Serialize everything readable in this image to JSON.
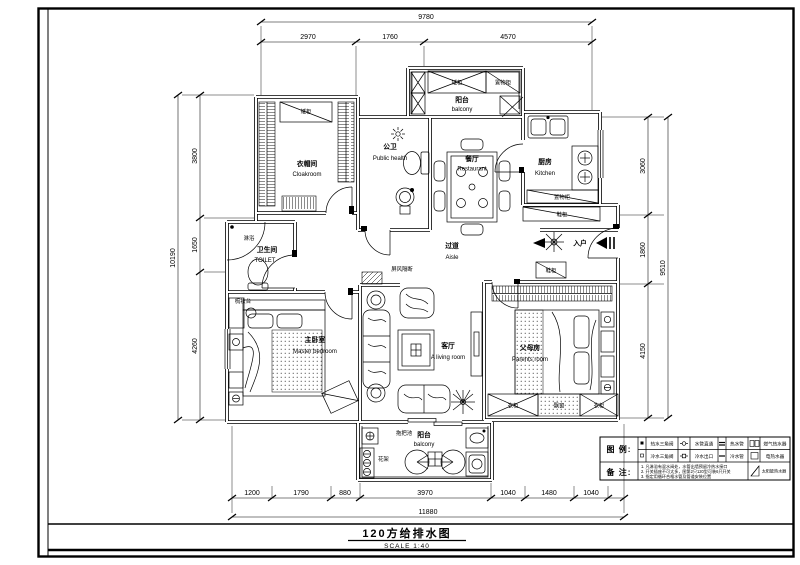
{
  "sheet": {
    "title": "120方给排水图",
    "scale_line": "SCALE    1:40"
  },
  "dims": {
    "top_total": "9780",
    "top": [
      "2970",
      "1760",
      "4570"
    ],
    "left_total": "10190",
    "left": [
      "3800",
      "1650",
      "4260"
    ],
    "right_total": "9510",
    "right": [
      "3060",
      "1860",
      "4150"
    ],
    "bottom_total": "11880",
    "bottom": [
      "1200",
      "1790",
      "880",
      "3970",
      "1040",
      "1480",
      "1040"
    ]
  },
  "rooms": {
    "cloakroom": {
      "zh": "衣帽间",
      "en": "Cloakroom"
    },
    "public_bath": {
      "zh": "公卫",
      "en": "Public health"
    },
    "balcony_top": {
      "zh": "阳台",
      "en": "balcony"
    },
    "kitchen": {
      "zh": "厨房",
      "en": "Kitchen"
    },
    "dining": {
      "zh": "餐厅",
      "en": "Restaurant"
    },
    "aisle": {
      "zh": "过道",
      "en": "Aisle"
    },
    "toilet": {
      "zh": "卫生间",
      "en": "TOILET"
    },
    "master": {
      "zh": "主卧室",
      "en": "Master bedroom"
    },
    "living": {
      "zh": "客厅",
      "en": "A living room"
    },
    "parents": {
      "zh": "父母房",
      "en": "Parents room"
    },
    "balcony_bottom": {
      "zh": "阳台",
      "en": "balcony"
    }
  },
  "fixtures": {
    "low_cabinet": "矮柜",
    "storage_cabinet": "置物柜",
    "shoe_cabinet": "鞋柜",
    "shower": "淋浴",
    "dresser": "梳妆台",
    "screen_partition": "屏风隔断",
    "entry": "入户",
    "wardrobe": "衣柜",
    "bay_window": "飘窗",
    "mop_pool": "拖把池",
    "flower_rack": "花架"
  },
  "legend": {
    "title": "图 例:",
    "notes_title": "备 注:",
    "rows": [
      {
        "c1": "热水三角阀",
        "c2": "水管直通",
        "c3": "热水管",
        "c4": "燃气热水器"
      },
      {
        "c1": "冷水三角阀",
        "c2": "冷水出口",
        "c3": "冷水管",
        "c4": "电热水器"
      }
    ],
    "solar": "太阳能热水器",
    "notes": [
      "1. 凡淋浴有混水阀处，水管出墙预留冷热水接口",
      "2. 开关插座不可太多，图第2只120型可装6只开关",
      "3. 指定用循环合格水管及管道安装位置"
    ]
  }
}
